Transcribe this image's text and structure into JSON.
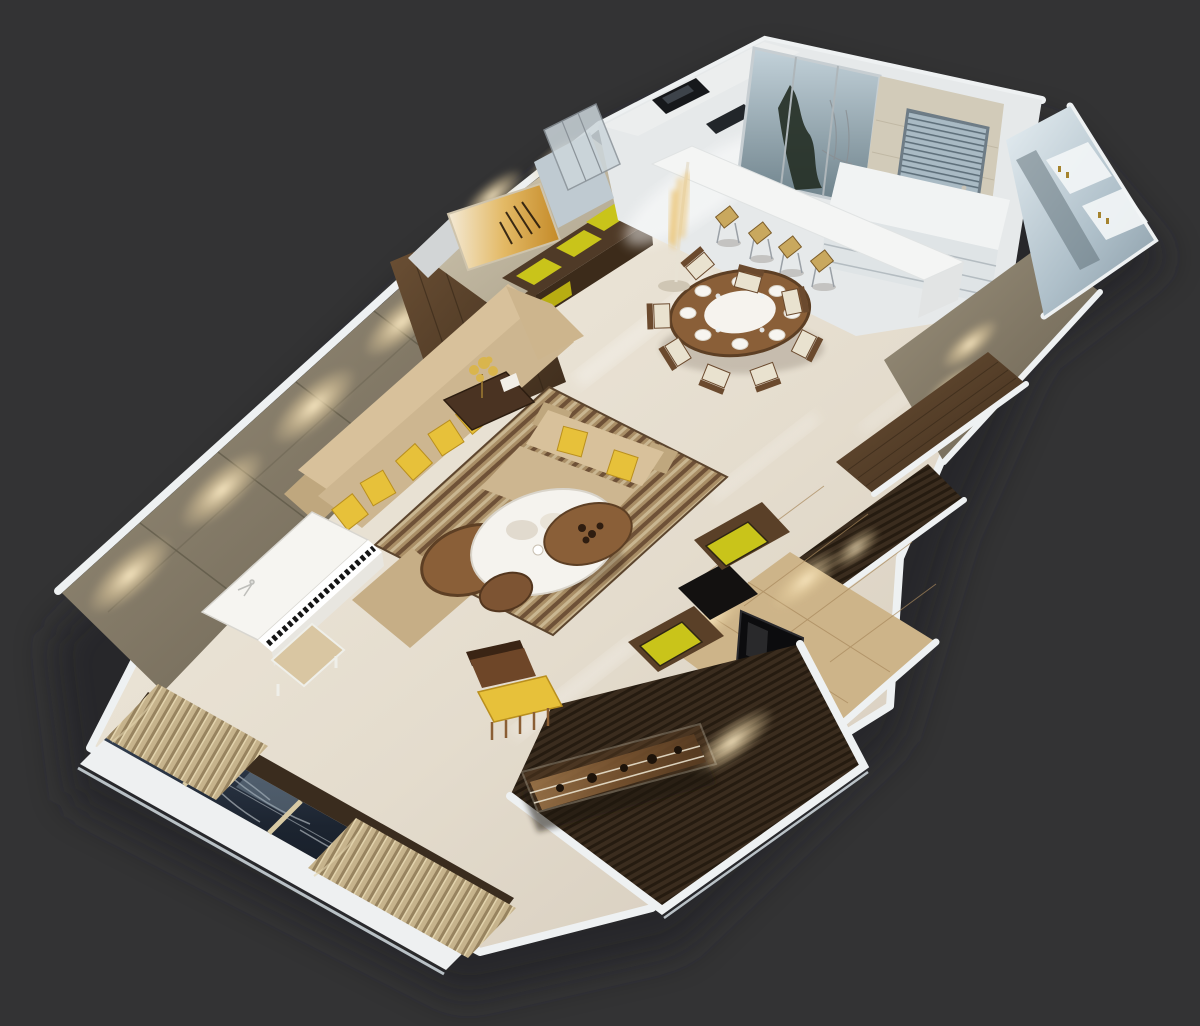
{
  "meta": {
    "description": "Isometric 3D cutaway floor-plan render of an apartment interior viewed from above on a dark charcoal backdrop",
    "view": "top-down isometric render, no visible text"
  },
  "palette": {
    "bg": "#333334",
    "shadow": "#232325",
    "outerWallWhite": "#eef1f2",
    "outerWallGray": "#b9c1c6",
    "marbleFloor": "#e8e1d4",
    "featureWallTaupe": "#8e8471",
    "lightPool": "#f6e7c2",
    "walnut": "#5d4430",
    "walnutDark": "#3c2b1b",
    "woodSlatDark": "#31251a",
    "chartreuse": "#c9c41a",
    "pillowYellow": "#e7c13a",
    "sofaBeige": "#cdb690",
    "sofaBack": "#d8c19b",
    "sofaShadow": "#bfa77e",
    "rugLight": "#c9b691",
    "rugDark": "#6e5137",
    "pianoWhite": "#f6f5f1",
    "benchBeige": "#d9c6a2",
    "curtainTan": "#b5a27e",
    "windowNight": "#1c242e",
    "windowFrameTan": "#d8caa4",
    "kitchenWhite": "#eceeee",
    "glassBlue": "#9fb3be",
    "stoneBeige": "#d2cbb9",
    "blindsBlue": "#9fb2bd",
    "mirrorSilver": "#cdd9df",
    "tileBeige": "#cdb489",
    "tvBlack": "#0c0c0e",
    "steelGray": "#9aa0a6",
    "woodMid": "#8a5f38",
    "chairCream": "#e9e2cf",
    "plateWhite": "#f7f5f0",
    "stoolWood": "#c9a85e",
    "brassGold": "#a5832e",
    "copperGlow": "#c89a63",
    "ovenBlack": "#16181b"
  },
  "scene": {
    "rooms": [
      {
        "name": "kitchen",
        "items": [
          "glass-sliding-door",
          "evergreen-tree-outside",
          "stone-wall",
          "window-with-blinds",
          "white-drawer-island",
          "built-in-oven",
          "cooktop",
          "glass-display-case",
          "bar-counter",
          "bar-stools",
          "decorative-floor-lamp"
        ],
        "bar_stool_count": 4
      },
      {
        "name": "dining-area",
        "items": [
          "round-dining-table",
          "lazy-susan-center",
          "dining-chairs",
          "place-settings",
          "sideboard-with-chartreuse-panels",
          "abstract-amber-painting"
        ],
        "chair_count": 8,
        "place_setting_count": 8
      },
      {
        "name": "living-room",
        "items": [
          "feature-wall-with-spotlights",
          "sectional-sofa",
          "yellow-throw-pillows",
          "loveseat",
          "striped-area-rug",
          "white-round-coffee-table",
          "wood-nesting-tables",
          "side-table-with-gold-tree",
          "white-upright-piano",
          "piano-bench",
          "armchair-with-yellow-cushion"
        ],
        "wall_spotlight_count": 4,
        "sofa_pillow_count": 5
      },
      {
        "name": "tv-wall",
        "items": [
          "beige-tile-wall",
          "flat-screen-tv",
          "media-consoles-with-yellow-shelves",
          "wood-slat-panels"
        ],
        "yellow_shelf_count": 2
      },
      {
        "name": "bathroom-vanity",
        "items": [
          "mirror-wall",
          "white-vanity-cabinets",
          "brass-faucets"
        ]
      },
      {
        "name": "hallway-wardrobe",
        "items": [
          "taupe-panel-wall-with-downlights",
          "wood-grain-wardrobe-band",
          "dark-slat-band"
        ]
      },
      {
        "name": "balcony-window-wall",
        "items": [
          "mullioned-window",
          "winter-trees-outside",
          "bunched-curtains",
          "white-sill-band",
          "dark-curtain-rail"
        ],
        "curtain_bunch_count": 2
      },
      {
        "name": "rear-deck",
        "items": [
          "dark-wood-slat-floor",
          "glass-display-shelf",
          "bonsai-decor"
        ]
      }
    ]
  }
}
